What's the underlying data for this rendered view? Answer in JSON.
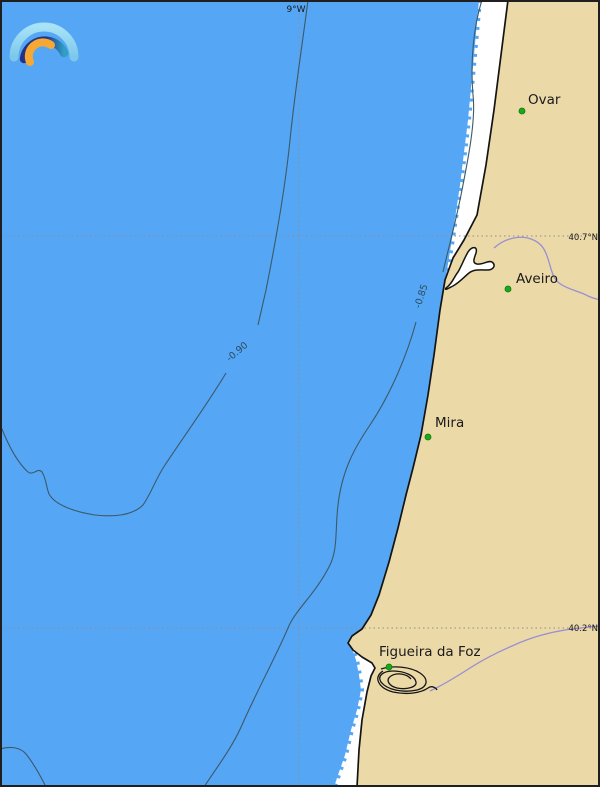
{
  "logo": {
    "name": "arc-rainbow-logo"
  },
  "grid": {
    "longitude_label": "9°W",
    "latitude_label_north": "40.7°N",
    "latitude_label_south": "40.2°N"
  },
  "contours": {
    "level_090": "-0.90",
    "level_085": "-0.85"
  },
  "places": {
    "ovar": "Ovar",
    "aveiro": "Aveiro",
    "mira": "Mira",
    "figueira_da_foz": "Figueira da Foz"
  },
  "colors": {
    "ocean": "#55a6f5",
    "land": "#ebd9a8",
    "shore_band": "#ffffff",
    "coastline": "#141414",
    "contour": "#3c5a68",
    "river": "#998fd2",
    "gridline": "#8f8f8f",
    "city_marker": "#1ba81b",
    "track": "#151515",
    "logo_outer": "#8cd4ef",
    "logo_middle_start": "#243286",
    "logo_middle_end": "#2f9fc4",
    "logo_inner": "#f7a833"
  }
}
